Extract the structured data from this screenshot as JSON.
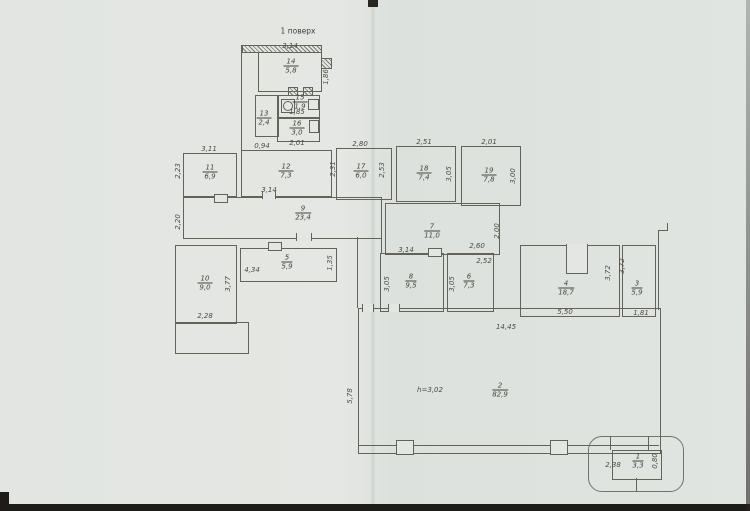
{
  "title": "1 поверх",
  "colors": {
    "paper": "#e2e5e1",
    "line": "#63635a",
    "text": "#4c4c44"
  },
  "rooms": {
    "r1": {
      "num": "1",
      "area": "3,3"
    },
    "r2": {
      "num": "2",
      "area": "82,9"
    },
    "r3": {
      "num": "3",
      "area": "5,9"
    },
    "r4": {
      "num": "4",
      "area": "18,7"
    },
    "r5": {
      "num": "5",
      "area": "5,9"
    },
    "r6": {
      "num": "6",
      "area": "7,3"
    },
    "r7": {
      "num": "7",
      "area": "11,0"
    },
    "r8": {
      "num": "8",
      "area": "9,5"
    },
    "r9": {
      "num": "9",
      "area": "23,4"
    },
    "r10": {
      "num": "10",
      "area": "9,0"
    },
    "r11": {
      "num": "11",
      "area": "6,9"
    },
    "r12": {
      "num": "12",
      "area": "7,3"
    },
    "r13": {
      "num": "13",
      "area": "2,4"
    },
    "r14": {
      "num": "14",
      "area": "5,8"
    },
    "r15": {
      "num": "15",
      "area": "1,9"
    },
    "r16": {
      "num": "16",
      "area": "3,0"
    },
    "r17": {
      "num": "17",
      "area": "6,0"
    },
    "r18": {
      "num": "18",
      "area": "7,4"
    },
    "r19": {
      "num": "19",
      "area": "7,8"
    }
  },
  "dims": {
    "d14_top": "3,14",
    "d14_right": "1,86",
    "d15_w": "1,85",
    "d16_w": "2,01",
    "d13_left": "0,94",
    "d11_top": "3,11",
    "d11_left": "2,23",
    "d12_bottom": "3,14",
    "d12_right": "2,31",
    "d17_top": "2,80",
    "d17_right": "2,53",
    "d18_top": "2,51",
    "d18_right": "3,05",
    "d19_top": "2,01",
    "d19_right": "3,00",
    "d9_left": "2,20",
    "d7_a": "2,60",
    "d7_b": "2,52",
    "d7_right": "2,00",
    "d5_w": "4,34",
    "d5_right": "1,35",
    "d10_bottom": "2,28",
    "d10_right": "3,77",
    "d8_top": "3,14",
    "d8_left": "3,05",
    "d6_left": "3,05",
    "d4_bottom": "5,50",
    "d3_left_a": "3,72",
    "d3_left_b": "3,72",
    "d3_bottom": "1,81",
    "d2_top": "14,45",
    "d2_left": "5,78",
    "d2_height": "h=3,02",
    "d1_left": "2,38",
    "d1_right": "0,80"
  }
}
